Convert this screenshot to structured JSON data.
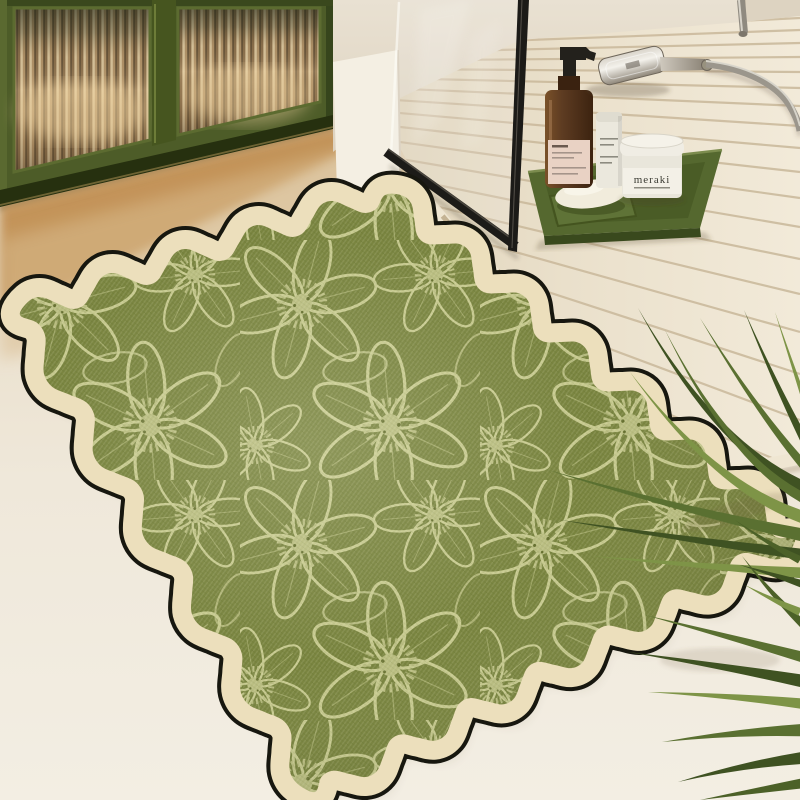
{
  "meta": {
    "image_type": "product-photograph",
    "subject": "Wavy-edge green floral bath mat styled in a bathroom with glass shower, wooden slat duckboard, green fluted-glass cabinet and palm fronds"
  },
  "objects": {
    "bath_mat": {
      "name": "floral bath mat",
      "shape": "wavy scalloped rectangle seen in perspective",
      "pattern": "cream line-art flowers with fuzzy stamen centers on olive green",
      "border": "cream band with thin black outer trim"
    },
    "cabinet": {
      "name": "olive green cabinet with fluted glass doors",
      "doors": 2
    },
    "duckboard": {
      "name": "wooden slat shower platform"
    },
    "shower_glass": {
      "name": "black framed glass shower screen"
    },
    "hand_shower": {
      "name": "chrome handheld shower head with flexible hose"
    },
    "tray": {
      "name": "green stone tray",
      "items": [
        "amber glass pump bottle",
        "white cosmetic tube",
        "white cream jar",
        "green soap dish",
        "white soap bar"
      ]
    },
    "jar": {
      "brand_text": "meraki"
    },
    "plant": {
      "name": "palm fronds"
    }
  },
  "colors": {
    "rug_green": "#79843f",
    "rug_flower_line": "#c6c98e",
    "rug_flower_center": "#b9bd80",
    "rug_border": "#ecdfbc",
    "rug_trim": "#17170f",
    "floor": "#ece4d6",
    "floor_glow": "#c08d4f",
    "wall": "#e6ddcc",
    "wall_corner_white": "#f4efe3",
    "cabinet_green": "#4d5c28",
    "cabinet_green_dark": "#26300f",
    "fluted_glass": "#b2946a",
    "duckboard": "#eae0cb",
    "duckboard_gap": "#c9b89a",
    "glass_frame": "#1c1b18",
    "tray_green": "#55682f",
    "soap": "#f1ecdc",
    "bottle_amber": "#5e3c22",
    "bottle_label": "#e9d2c4",
    "tube_white": "#ebe8dd",
    "jar_white": "#e9e6db",
    "chrome": "#9b968c",
    "palm_dark": "#3f5222",
    "palm_mid": "#5a7031",
    "palm_light": "#7e9447"
  }
}
